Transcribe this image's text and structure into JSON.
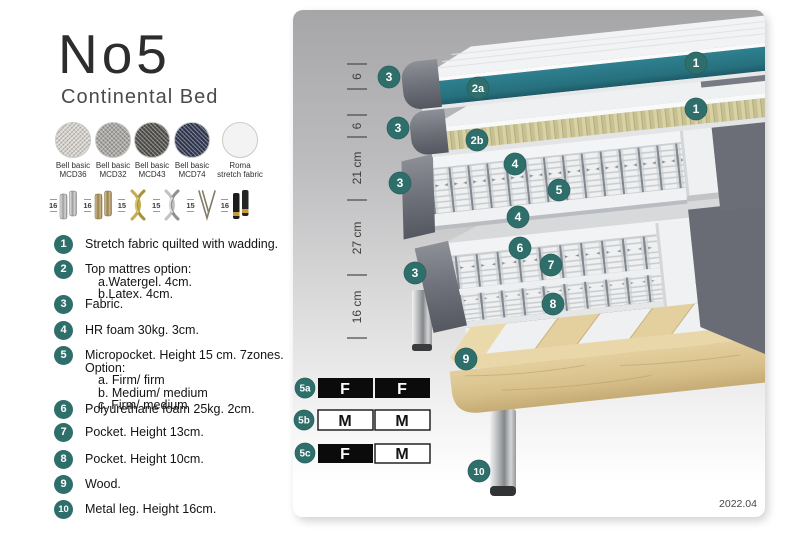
{
  "header": {
    "title": "No5",
    "subtitle": "Continental Bed"
  },
  "swatches": [
    {
      "line1": "Bell basic",
      "line2": "MCD36"
    },
    {
      "line1": "Bell basic",
      "line2": "MCD32"
    },
    {
      "line1": "Bell basic",
      "line2": "MCD43"
    },
    {
      "line1": "Bell basic",
      "line2": "MCD74"
    },
    {
      "line1": "Roma",
      "line2": "stretch fabric"
    }
  ],
  "legs": [
    {
      "height": "16",
      "type": "cylinder-silver"
    },
    {
      "height": "16",
      "type": "cylinder-brass"
    },
    {
      "height": "15",
      "type": "twist-gold"
    },
    {
      "height": "15",
      "type": "twist-silver"
    },
    {
      "height": "15",
      "type": "hairpin"
    },
    {
      "height": "16",
      "type": "cylinder-black-gold"
    }
  ],
  "list": [
    {
      "num": "1",
      "text": "Stretch fabric quilted with wadding.",
      "sublines": []
    },
    {
      "num": "2",
      "text": "Top mattres option:",
      "sublines": [
        "a.Watergel. 4cm.",
        "b.Latex. 4cm."
      ]
    },
    {
      "num": "3",
      "text": "Fabric.",
      "sublines": []
    },
    {
      "num": "4",
      "text": "HR foam 30kg. 3cm.",
      "sublines": []
    },
    {
      "num": "5",
      "text": "Micropocket. Height 15 cm. 7zones. Option:",
      "sublines": [
        "a. Firm/ firm",
        "b. Medium/ medium",
        "c. Firm/ medium"
      ]
    },
    {
      "num": "6",
      "text": "Polyurethane foam 25kg. 2cm.",
      "sublines": []
    },
    {
      "num": "7",
      "text": "Pocket. Height 13cm.",
      "sublines": []
    },
    {
      "num": "8",
      "text": "Pocket. Height 10cm.",
      "sublines": []
    },
    {
      "num": "9",
      "text": "Wood.",
      "sublines": []
    },
    {
      "num": "10",
      "text": "Metal leg. Height 16cm.",
      "sublines": []
    }
  ],
  "diagram": {
    "measurements": [
      "6",
      "6",
      "21 cm",
      "27 cm",
      "16 cm"
    ],
    "badges": [
      {
        "label": "3"
      },
      {
        "label": "2a"
      },
      {
        "label": "1"
      },
      {
        "label": "3"
      },
      {
        "label": "2b"
      },
      {
        "label": "1"
      },
      {
        "label": "4"
      },
      {
        "label": "3"
      },
      {
        "label": "5"
      },
      {
        "label": "4"
      },
      {
        "label": "6"
      },
      {
        "label": "3"
      },
      {
        "label": "7"
      },
      {
        "label": "8"
      },
      {
        "label": "9"
      },
      {
        "label": "10"
      }
    ],
    "firmness": [
      {
        "id": "5a",
        "left": "F",
        "right": "F",
        "left_style": "dark",
        "right_style": "dark"
      },
      {
        "id": "5b",
        "left": "M",
        "right": "M",
        "left_style": "light",
        "right_style": "light"
      },
      {
        "id": "5c",
        "left": "F",
        "right": "M",
        "left_style": "dark",
        "right_style": "light"
      }
    ],
    "version": "2022.04",
    "colors": {
      "badge_teal": "#2f6f6b",
      "mattress_teal": "#2e7d8a",
      "wood": "#dcc795"
    }
  }
}
